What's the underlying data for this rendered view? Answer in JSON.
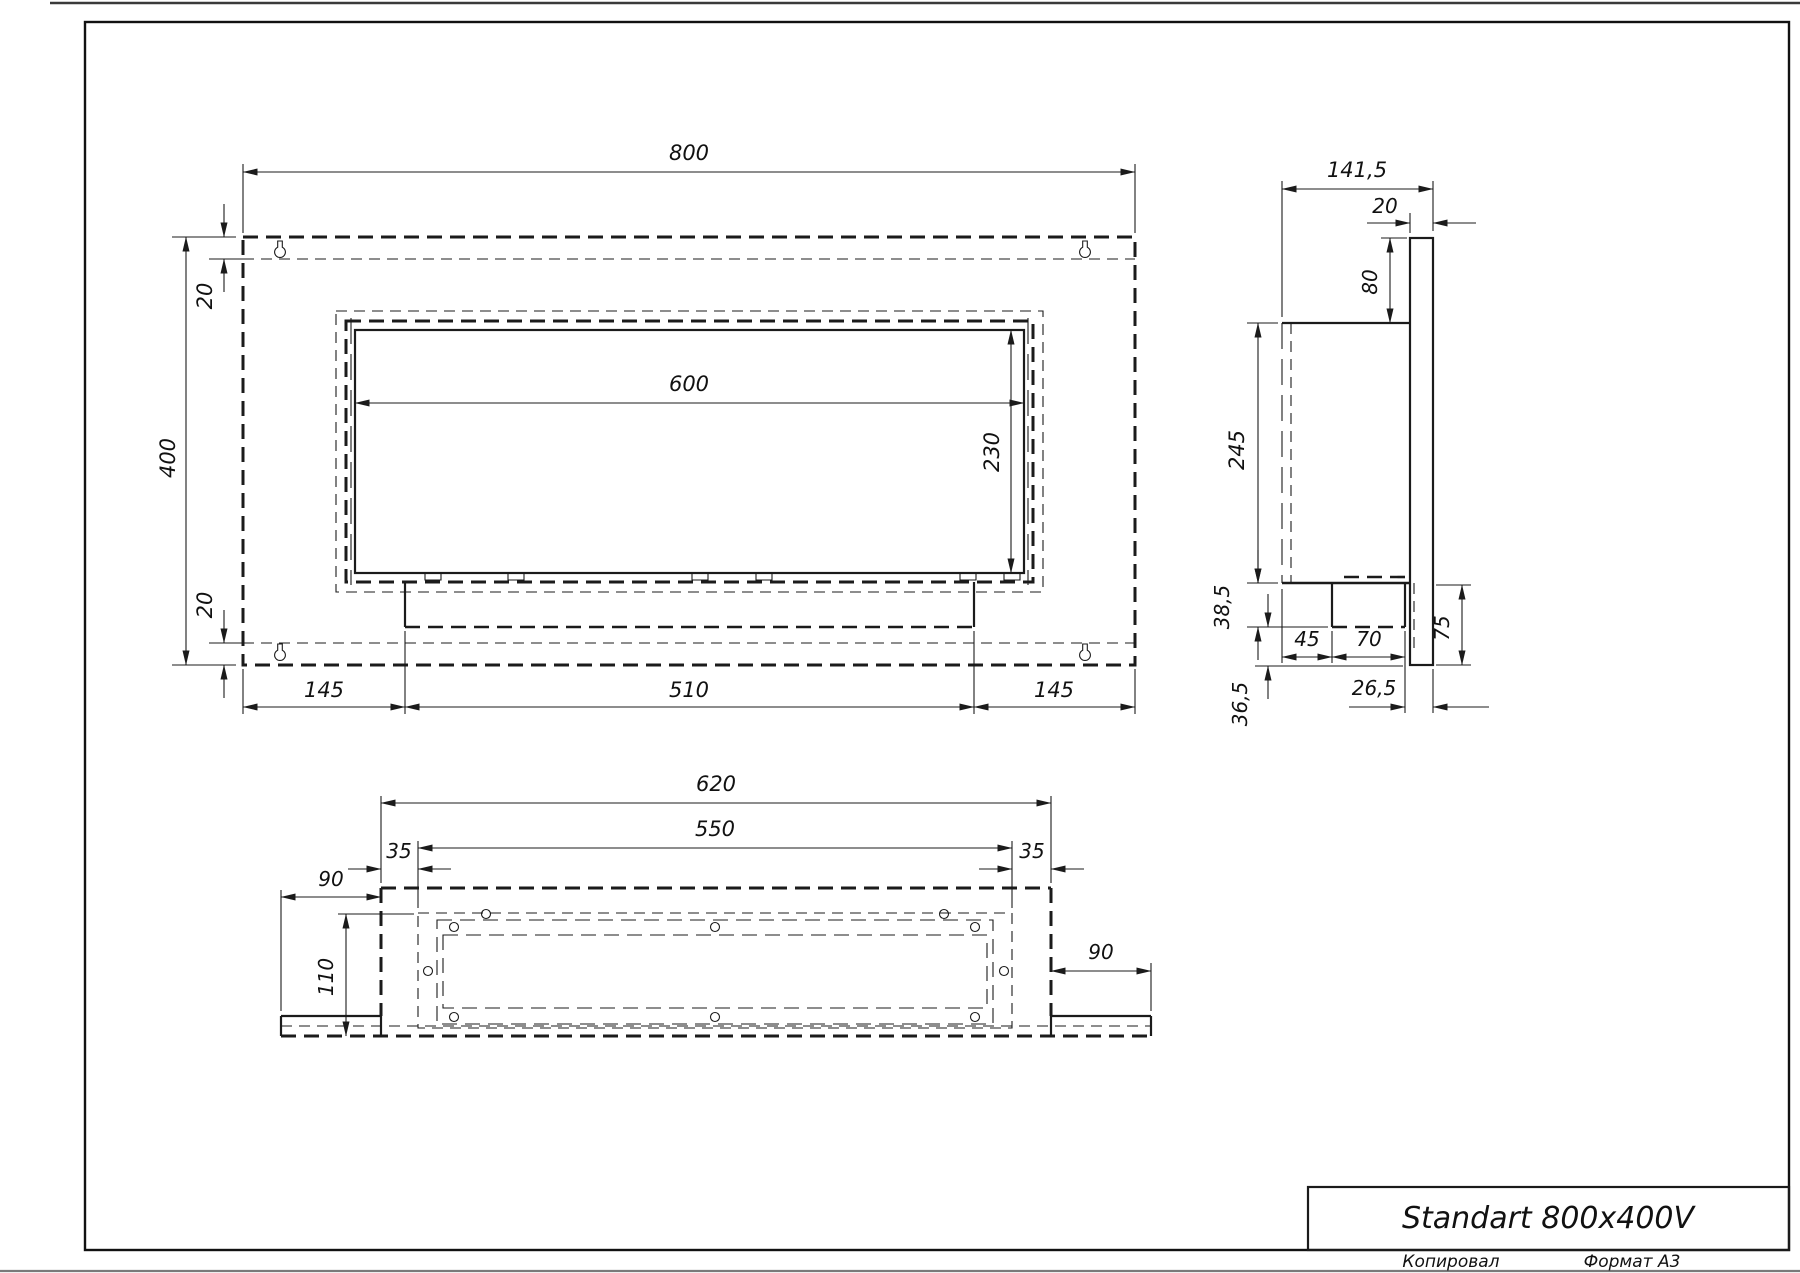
{
  "title_block": {
    "title": "Standart 800x400V",
    "copied_label": "Копировал",
    "format_label": "Формат А3"
  },
  "front_view": {
    "dims": {
      "overall_width": "800",
      "overall_height": "400",
      "top_flange": "20",
      "bottom_flange": "20",
      "opening_width": "600",
      "opening_height": "230",
      "left_offset": "145",
      "burner_width": "510",
      "right_offset": "145"
    }
  },
  "side_view": {
    "dims": {
      "overall_depth": "141,5",
      "panel_thickness": "20",
      "top_drop": "80",
      "body_height": "245",
      "tray_height": "38,5",
      "bottom_lip_gap": "36,5",
      "back_offset": "45",
      "tray_depth": "70",
      "front_offset": "26,5",
      "lower_lip": "75"
    }
  },
  "bottom_view": {
    "dims": {
      "body_width": "620",
      "opening_width": "550",
      "left_inset": "35",
      "right_inset": "35",
      "left_wing": "90",
      "right_wing": "90",
      "body_depth": "110"
    }
  }
}
